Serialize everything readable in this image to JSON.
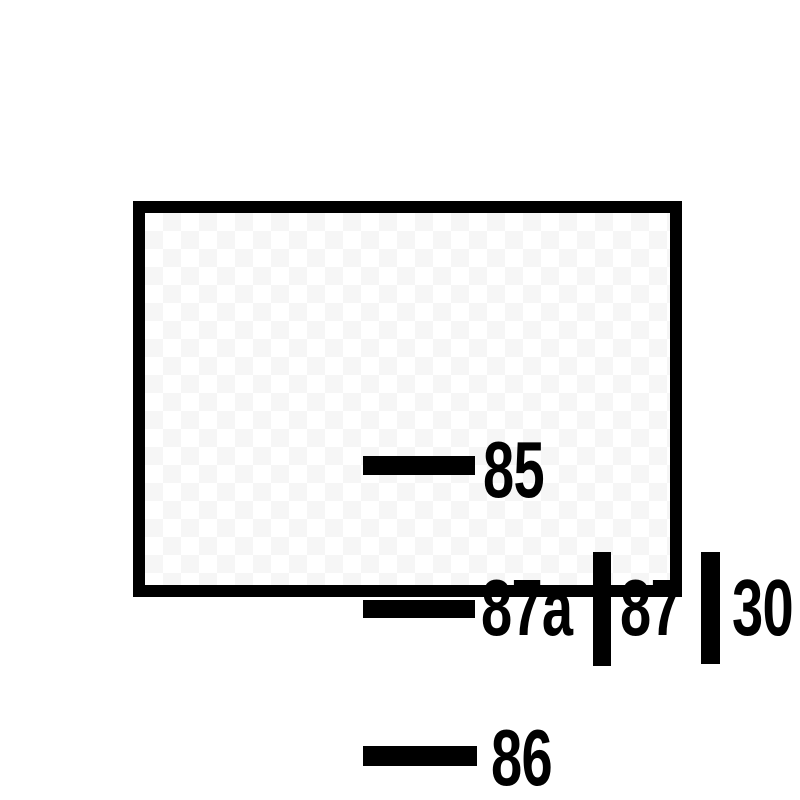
{
  "diagram": {
    "kind": "relay-terminal-pinout",
    "pins": {
      "p85": {
        "label": "85",
        "terminal_orientation": "horizontal"
      },
      "p87a": {
        "label": "87a",
        "terminal_orientation": "horizontal"
      },
      "p87": {
        "label": "87",
        "terminal_orientation": "vertical"
      },
      "p30": {
        "label": "30",
        "terminal_orientation": "vertical"
      },
      "p86": {
        "label": "86",
        "terminal_orientation": "horizontal"
      }
    },
    "colors": {
      "ink": "#000000",
      "background": "#ffffff",
      "checker_tint": "#f6f6f6"
    }
  }
}
